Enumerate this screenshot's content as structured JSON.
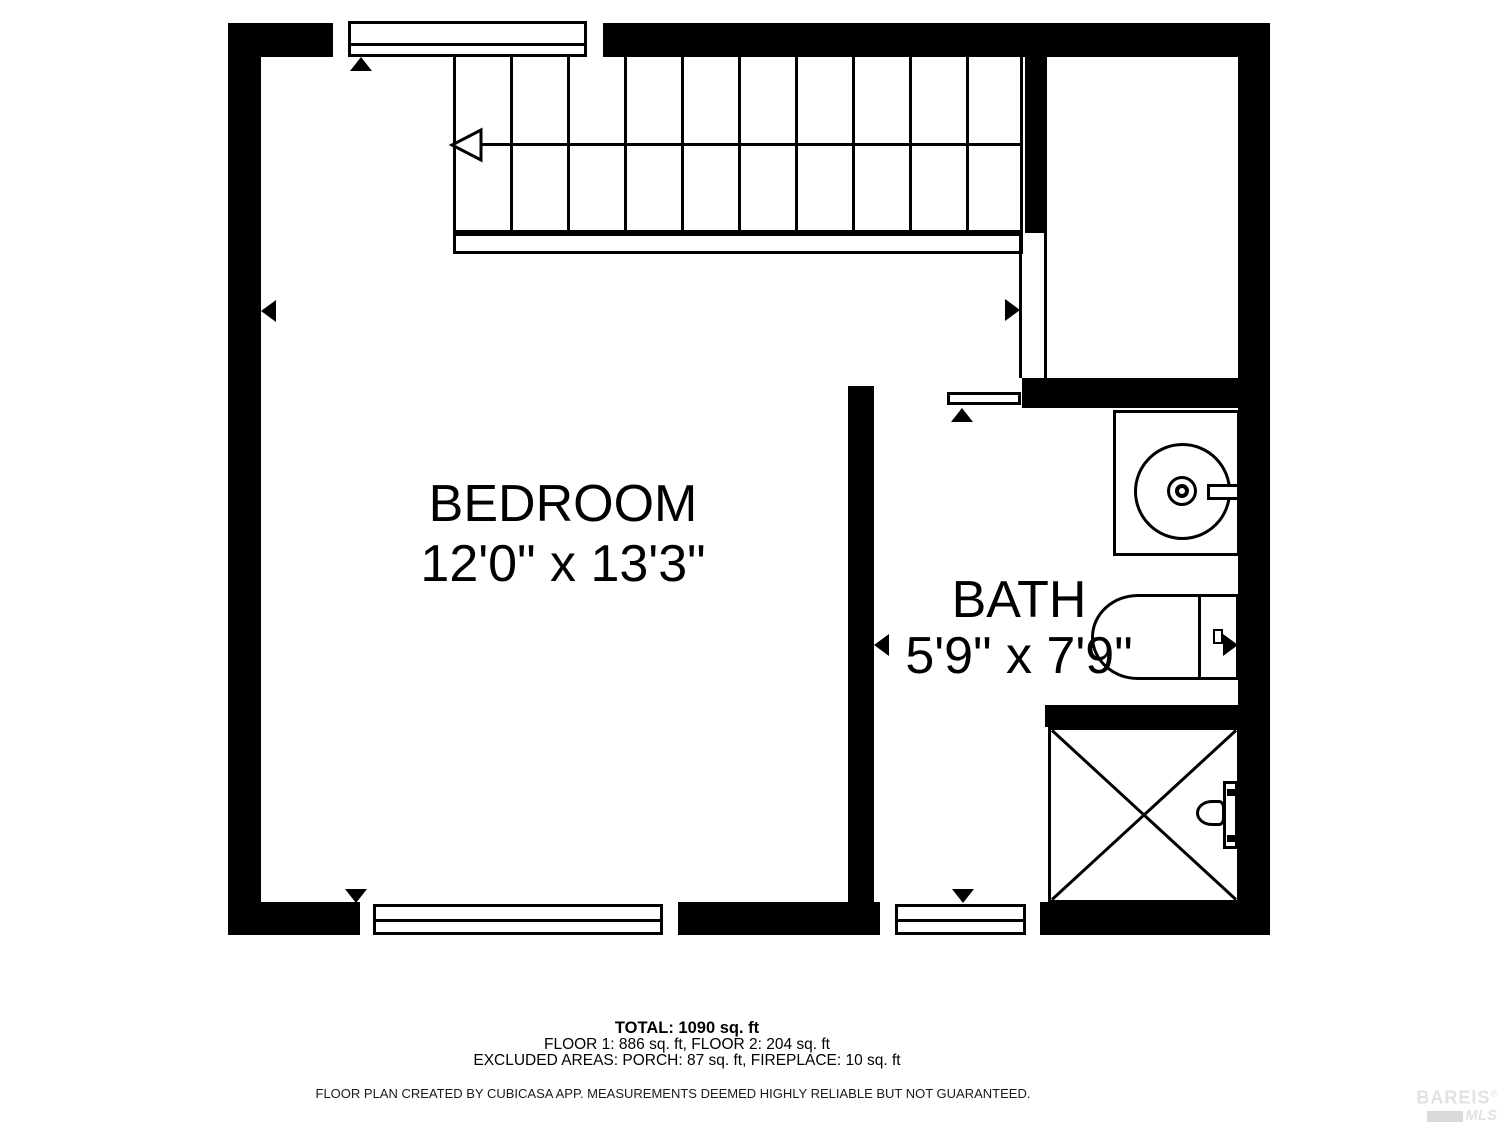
{
  "floor_plan": {
    "rooms": [
      {
        "name": "BEDROOM",
        "dimensions": "12'0\" x 13'3\""
      },
      {
        "name": "BATH",
        "dimensions": "5'9\" x 7'9\""
      }
    ],
    "features": [
      "stairs",
      "top-window",
      "bedroom-window",
      "bath-window",
      "bath-door",
      "sink",
      "toilet",
      "shower"
    ]
  },
  "footer": {
    "total": "TOTAL: 1090 sq. ft",
    "floor_breakdown": "FLOOR 1: 886 sq. ft, FLOOR 2: 204 sq. ft",
    "excluded_areas": "EXCLUDED AREAS: PORCH: 87 sq. ft, FIREPLACE: 10 sq. ft",
    "disclaimer": "FLOOR PLAN CREATED BY CUBICASA APP. MEASUREMENTS DEEMED HIGHLY RELIABLE BUT NOT GUARANTEED."
  },
  "logo": {
    "brand": "BAREIS",
    "registered": "®",
    "mls": "MLS"
  },
  "colors": {
    "wall": "#000000",
    "background": "#ffffff",
    "logo_gray": "#e2e2e2"
  }
}
